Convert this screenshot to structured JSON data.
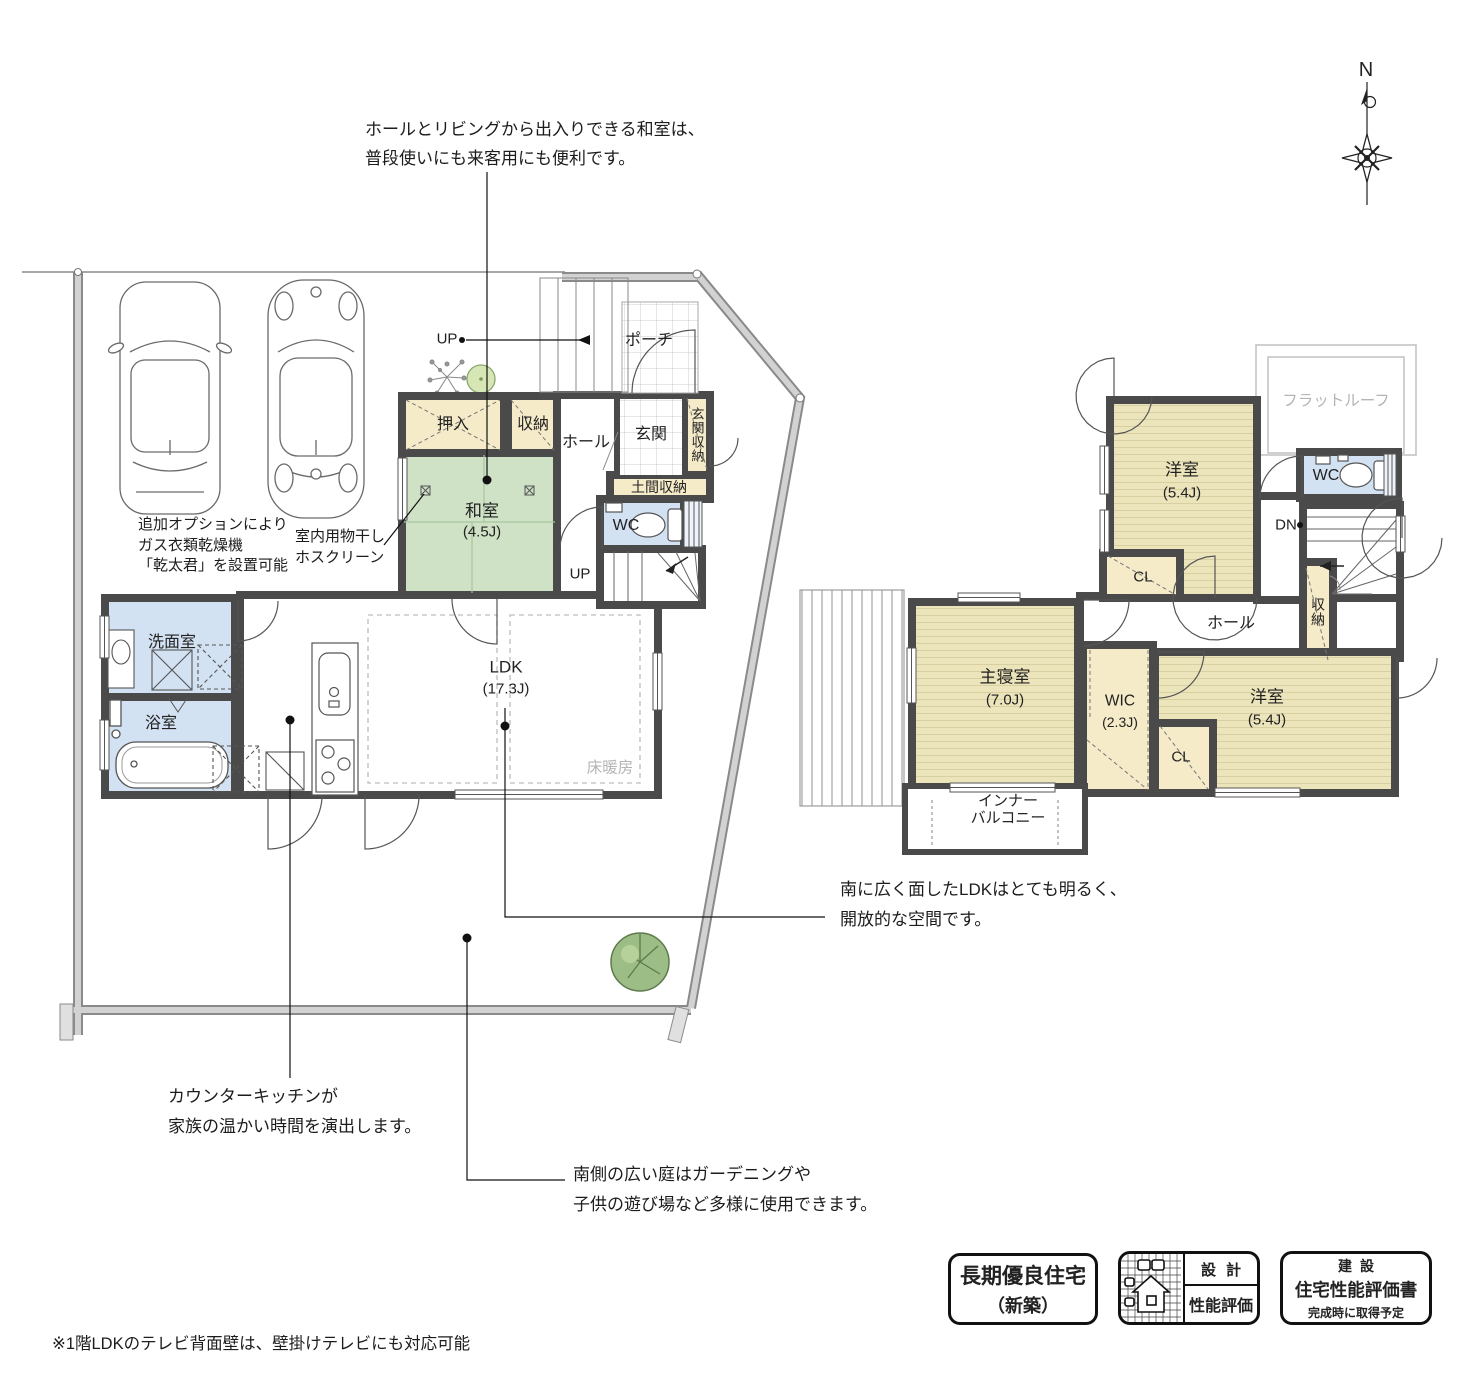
{
  "compass": {
    "north": "N"
  },
  "notes": {
    "washitsu_note_1": "ホールとリビングから出入りできる和室は、",
    "washitsu_note_2": "普段使いにも来客用にも便利です。",
    "dryer_note_1": "追加オプションにより",
    "dryer_note_2": "ガス衣類乾燥機",
    "dryer_note_3": "「乾太君」を設置可能",
    "hoscreen_note_1": "室内用物干し",
    "hoscreen_note_2": "ホスクリーン",
    "ldk_note_1": "南に広く面したLDKはとても明るく、",
    "ldk_note_2": "開放的な空間です。",
    "kitchen_note_1": "カウンターキッチンが",
    "kitchen_note_2": "家族の温かい時間を演出します。",
    "garden_note_1": "南側の広い庭はガーデニングや",
    "garden_note_2": "子供の遊び場など多様に使用できます。",
    "footnote": "※1階LDKのテレビ背面壁は、壁掛けテレビにも対応可能"
  },
  "floor1": {
    "oshiire": "押入",
    "shuno": "収納",
    "hall": "ホール",
    "genkan": "玄関",
    "genkan_shuno": "玄関収納",
    "doma_shuno": "土間収納",
    "porch": "ポーチ",
    "washitsu_name": "和室",
    "washitsu_size": "(4.5J)",
    "wc": "WC",
    "senmen": "洗面室",
    "yokushitsu": "浴室",
    "ldk_name": "LDK",
    "ldk_size": "(17.3J)",
    "yukadanbo": "床暖房",
    "up_top": "UP",
    "up_mid": "UP"
  },
  "floor2": {
    "flat_roof": "フラットルーフ",
    "yoshitsu_n_name": "洋室",
    "yoshitsu_n_size": "(5.4J)",
    "wc": "WC",
    "dn": "DN",
    "cl_n": "CL",
    "shuno": "収納",
    "hall": "ホール",
    "shushinshitsu_name": "主寝室",
    "shushinshitsu_size": "(7.0J)",
    "wic_name": "WIC",
    "wic_size": "(2.3J)",
    "cl_s": "CL",
    "yoshitsu_s_name": "洋室",
    "yoshitsu_s_size": "(5.4J)",
    "balcony_1": "インナー",
    "balcony_2": "バルコニー"
  },
  "badges": {
    "b1_line1": "長期優良住宅",
    "b1_line2": "（新築）",
    "b2_top": "設計",
    "b2_bottom": "性能評価",
    "b3_line1": "建設",
    "b3_line2": "住宅性能評価書",
    "b3_line3": "完成時に取得予定"
  },
  "colors": {
    "wall": "#4a4a4a",
    "tatami_green": "#cfe2c6",
    "wood_yellow": "#ece5bc",
    "closet_cream": "#f6ebc9",
    "wet_blue": "#d3e2f2",
    "boundary_gray": "#c9c9c9"
  }
}
